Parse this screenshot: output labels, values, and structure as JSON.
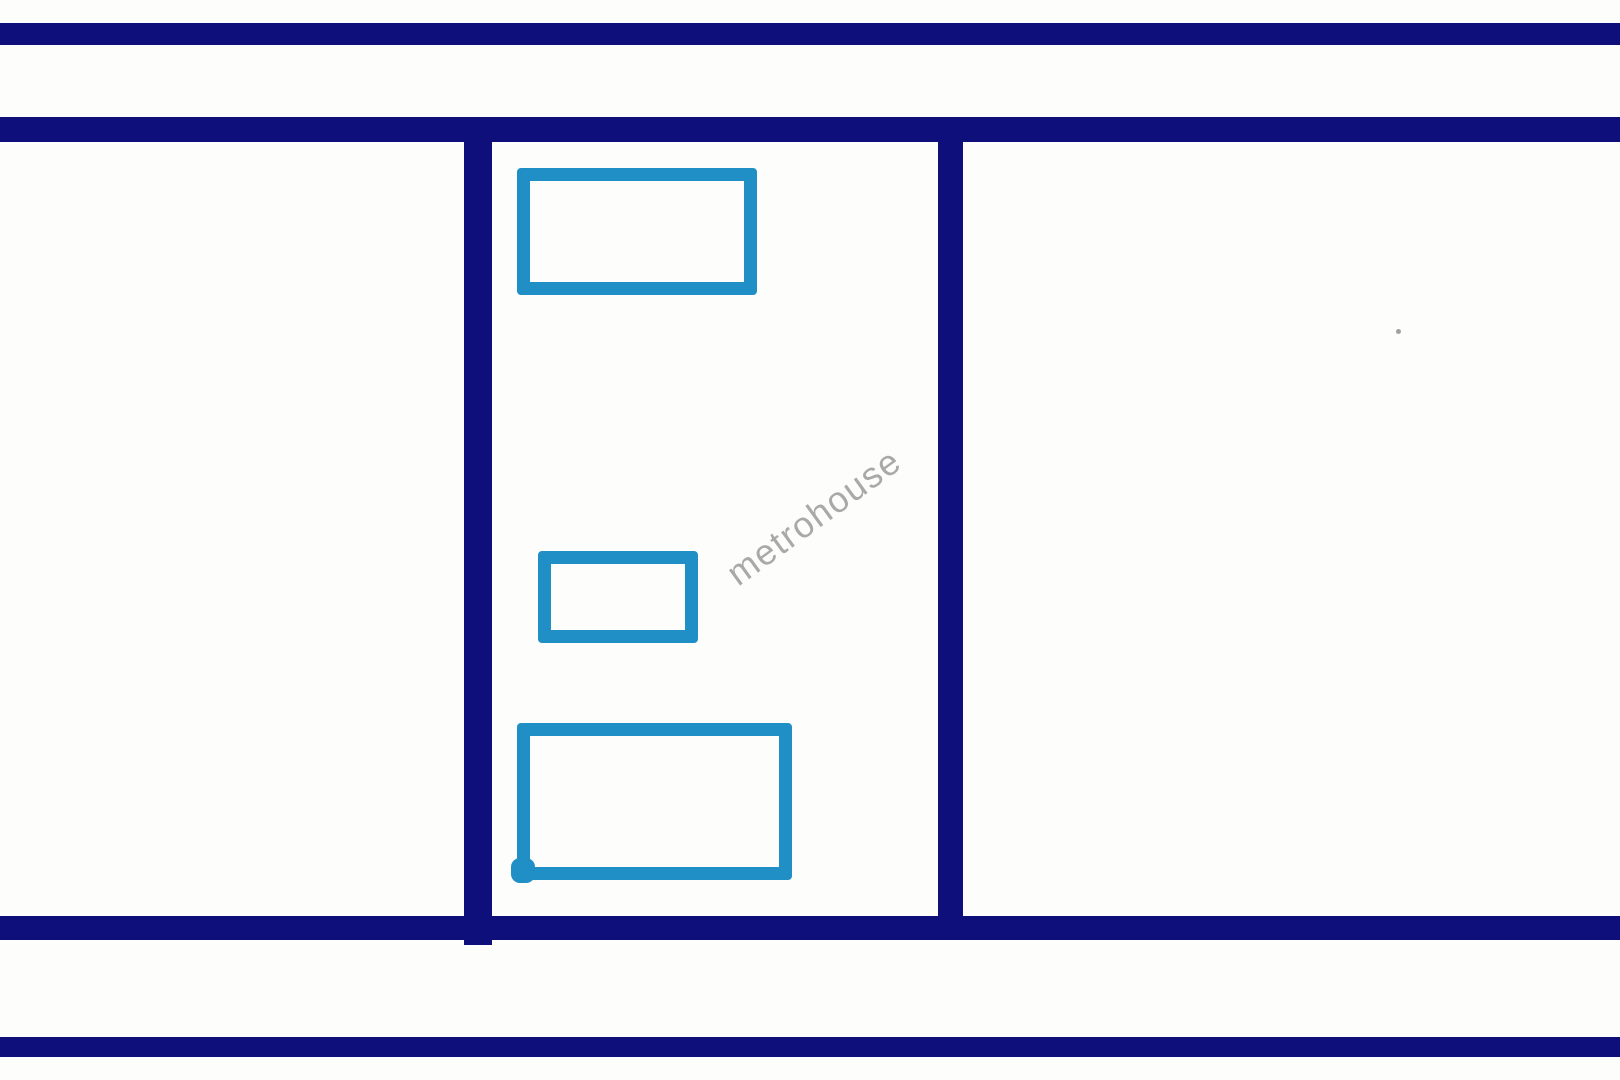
{
  "watermark": {
    "text": "metrohouse"
  },
  "colors": {
    "background": "#fdfdfc",
    "navy": "#0f0f7c",
    "cyan": "#1f8fc5",
    "watermark": "#9b9b9b",
    "speck": "#8a8a8a"
  },
  "shapes": [
    {
      "name": "top-outer-band",
      "kind": "band",
      "x": 0,
      "y": 23,
      "w": 1620,
      "h": 22
    },
    {
      "name": "top-inner-band",
      "kind": "band",
      "x": 0,
      "y": 117,
      "w": 1620,
      "h": 25
    },
    {
      "name": "bottom-inner-band",
      "kind": "band",
      "x": 0,
      "y": 916,
      "w": 1620,
      "h": 24
    },
    {
      "name": "bottom-outer-band",
      "kind": "band",
      "x": 0,
      "y": 1037,
      "w": 1620,
      "h": 20
    },
    {
      "name": "left-vertical-divider",
      "kind": "pillar",
      "x": 464,
      "y": 142,
      "w": 28,
      "h": 803
    },
    {
      "name": "right-vertical-divider",
      "kind": "pillar",
      "x": 938,
      "y": 142,
      "w": 25,
      "h": 798
    },
    {
      "name": "room-outline-top",
      "kind": "room",
      "x": 517,
      "y": 168,
      "w": 240,
      "h": 127
    },
    {
      "name": "room-outline-middle",
      "kind": "room",
      "x": 538,
      "y": 551,
      "w": 160,
      "h": 92
    },
    {
      "name": "room-outline-bottom",
      "kind": "room",
      "x": 517,
      "y": 723,
      "w": 275,
      "h": 157
    },
    {
      "name": "pen-stroke-blob",
      "kind": "blob",
      "x": 511,
      "y": 858,
      "w": 24,
      "h": 25
    }
  ]
}
